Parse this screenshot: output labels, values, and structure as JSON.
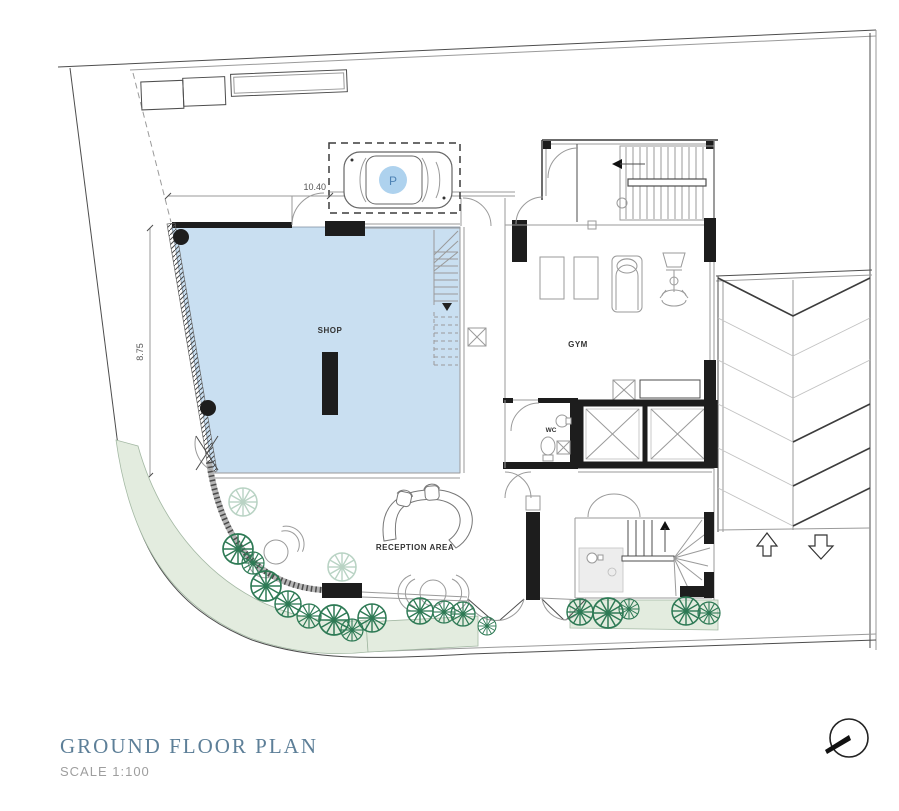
{
  "title_block": {
    "title": "GROUND FLOOR PLAN",
    "scale": "SCALE  1:100"
  },
  "rooms": {
    "shop": "SHOP",
    "gym": "GYM",
    "wc": "WC",
    "reception": "RECEPTION AREA"
  },
  "parking": {
    "symbol": "P"
  },
  "dimensions": {
    "frontage": "10.40",
    "depth": "8.75"
  },
  "colors": {
    "shop-fill": "#c9dff1",
    "wall": "#1d1d1d",
    "line": "#4d4d4d",
    "line-light": "#9a9a9a",
    "plant-fill": "#e3ecdf",
    "plant-edge": "#a3b8a3",
    "tree": "#2e7a55",
    "tree-light": "#b9d3c4",
    "parking-circle": "#aed2ee",
    "parking-letter": "#4d82b4",
    "title": "#5d7f98",
    "scale-text": "#9e9e9e"
  }
}
